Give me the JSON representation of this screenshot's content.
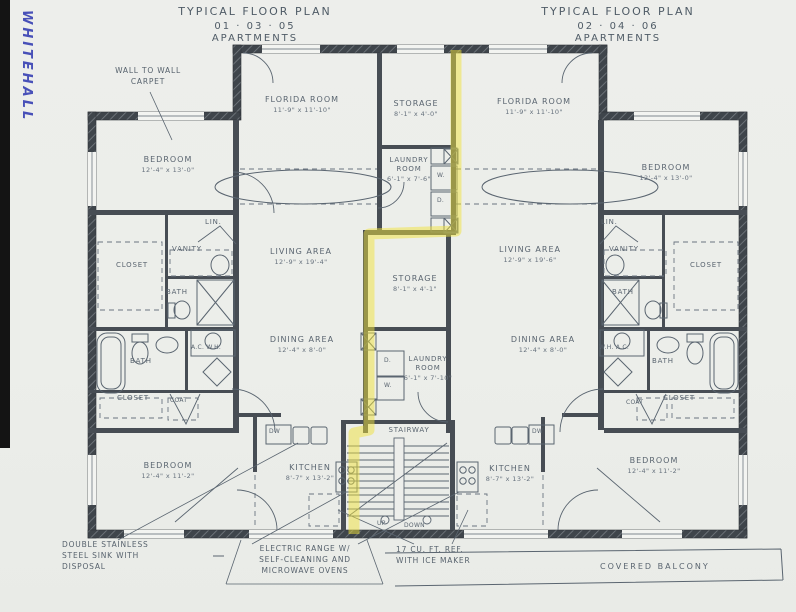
{
  "note": "WHITEHALL",
  "titles": {
    "left": {
      "line1": "TYPICAL FLOOR PLAN",
      "line2": "01 · 03 · 05",
      "line3": "APARTMENTS"
    },
    "right": {
      "line1": "TYPICAL FLOOR PLAN",
      "line2": "02 · 04 · 06",
      "line3": "APARTMENTS"
    }
  },
  "units": {
    "left": {
      "bedroom_top": {
        "name": "BEDROOM",
        "dims": "12'-4\" x 13'-0\""
      },
      "florida_room": {
        "name": "FLORIDA ROOM",
        "dims": "11'-9\" x 11'-10\""
      },
      "living_area": {
        "name": "LIVING AREA",
        "dims": "12'-9\" x 19'-4\""
      },
      "dining_area": {
        "name": "DINING AREA",
        "dims": "12'-4\" x 8'-0\""
      },
      "kitchen": {
        "name": "KITCHEN",
        "dims": "8'-7\" x 13'-2\""
      },
      "bedroom_bottom": {
        "name": "BEDROOM",
        "dims": "12'-4\" x 11'-2\""
      },
      "lin": "LIN.",
      "vanity": "VANITY",
      "closet_upper": "CLOSET",
      "bath_upper": "BATH",
      "ac_wh": "A.C. W.H.",
      "bath_lower": "BATH",
      "closet_lower": "CLOSET",
      "coat": "COAT",
      "dw": "DW"
    },
    "right": {
      "bedroom_top": {
        "name": "BEDROOM",
        "dims": "12'-4\" x 13'-0\""
      },
      "florida_room": {
        "name": "FLORIDA ROOM",
        "dims": "11'-9\" x 11'-10\""
      },
      "living_area": {
        "name": "LIVING AREA",
        "dims": "12'-9\" x 19'-6\""
      },
      "dining_area": {
        "name": "DINING AREA",
        "dims": "12'-4\" x 8'-0\""
      },
      "kitchen": {
        "name": "KITCHEN",
        "dims": "8'-7\" x 13'-2\""
      },
      "bedroom_bottom": {
        "name": "BEDROOM",
        "dims": "12'-4\" x 11'-2\""
      },
      "lin": "LIN.",
      "vanity": "VANITY",
      "closet_upper": "CLOSET",
      "bath_upper": "BATH",
      "wh_ac": "W.H. A.C.",
      "bath_lower": "BATH",
      "closet_lower": "CLOSET",
      "coat": "COAT",
      "dw": "DW"
    }
  },
  "core": {
    "storage_upper": {
      "name": "STORAGE",
      "dims": "8'-1\" x 4'-0\""
    },
    "laundry_upper": {
      "name": "LAUNDRY",
      "name2": "ROOM",
      "dims": "6'-1\" x 7'-6\""
    },
    "storage_lower": {
      "name": "STORAGE",
      "dims": "8'-1\" x 4'-1\""
    },
    "laundry_lower": {
      "name": "LAUNDRY",
      "name2": "ROOM",
      "dims": "6'-1\" x 7'-10\""
    },
    "stairway": "STAIRWAY",
    "up": "UP",
    "down": "DOWN",
    "washer": "W.",
    "dryer": "D."
  },
  "annotations": {
    "carpet": [
      "WALL TO WALL",
      "CARPET"
    ],
    "sink": [
      "DOUBLE STAINLESS",
      "STEEL SINK WITH",
      "DISPOSAL"
    ],
    "range": [
      "ELECTRIC RANGE W/",
      "SELF-CLEANING AND",
      "MICROWAVE OVENS"
    ],
    "refrigerator": [
      "17 CU. FT. REF.",
      "WITH ICE MAKER"
    ],
    "balcony": "COVERED BALCONY"
  },
  "colors": {
    "paper": "#edeeeb",
    "ink": "#5a6570",
    "wall": "#41474d",
    "highlight": "#f0e23c",
    "note_ink": "#2c35b0"
  }
}
